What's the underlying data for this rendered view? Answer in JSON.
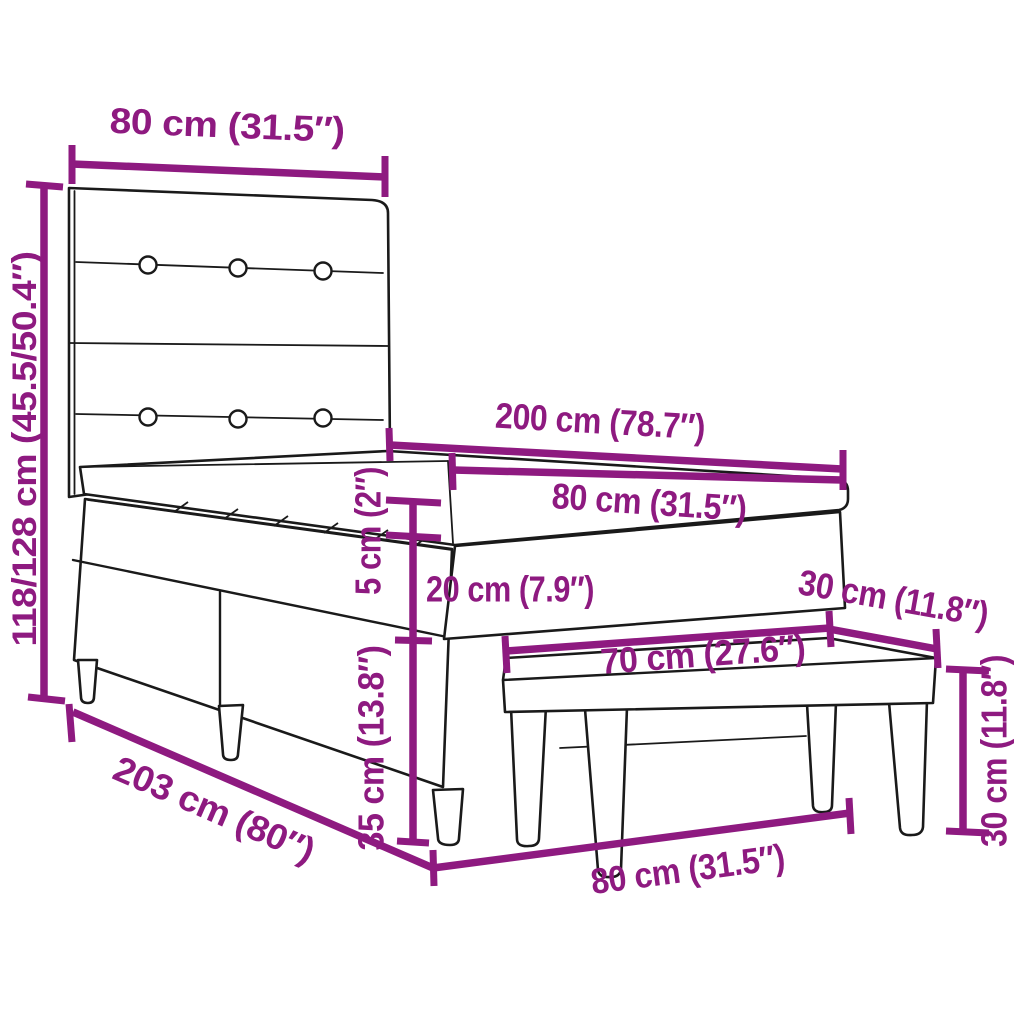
{
  "diagram": {
    "colors": {
      "dimension": "#8E1A80",
      "outline": "#1A1A1A",
      "background": "#FFFFFF"
    },
    "dimensions": {
      "headboard_width": "80 cm (31.5″)",
      "bed_height": "118/128 cm (45.5/50.4″)",
      "mattress_length": "200 cm (78.7″)",
      "mattress_width": "80 cm (31.5″)",
      "topper_thickness": "5 cm (2″)",
      "mattress_thickness": "20 cm (7.9″)",
      "base_height": "35 cm (13.8″)",
      "total_length": "203 cm (80″)",
      "bed_width_bottom": "80 cm (31.5″)",
      "bench_length": "70 cm (27.6″)",
      "bench_depth": "30 cm (11.8″)",
      "bench_height": "30 cm (11.8″)"
    }
  }
}
